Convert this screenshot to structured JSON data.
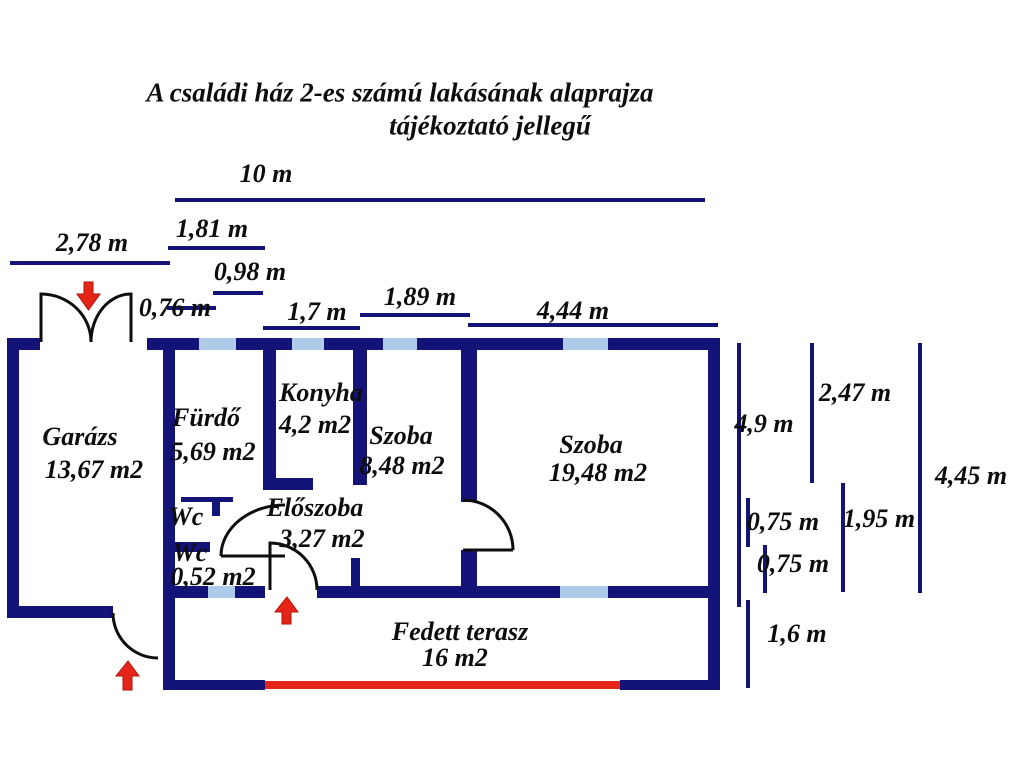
{
  "title": {
    "line1": "A családi ház 2-es számú lakásának alaprajza",
    "line2": "tájékoztató jellegű"
  },
  "rooms": {
    "garage": {
      "name": "Garázs",
      "area": "13,67 m2"
    },
    "bathroom": {
      "name": "Fürdő",
      "area": "5,69 m2"
    },
    "kitchen": {
      "name": "Konyha",
      "area": "4,2 m2"
    },
    "room_small": {
      "name": "Szoba",
      "area": "8,48 m2"
    },
    "room_large": {
      "name": "Szoba",
      "area": "19,48 m2"
    },
    "hallway": {
      "name": "Előszoba",
      "area": "3,27 m2"
    },
    "wc_upper": {
      "name": "Wc"
    },
    "wc_lower": {
      "name": "Wc",
      "area": "0,52 m2"
    },
    "terrace": {
      "name": "Fedett terasz",
      "area": "16 m2"
    }
  },
  "dimensions": {
    "total_width": "10 m",
    "garage_width": "2,78 m",
    "bathroom_width": "1,81 m",
    "window_width": "0,98 m",
    "garage_door_width": "0,76 m",
    "kitchen_width": "1,7 m",
    "room_small_width": "1,89 m",
    "room_large_width": "4,44 m",
    "right_height_full": "4,9 m",
    "room_large_height": "2,47 m",
    "total_height_right": "4,45 m",
    "offset_a": "0,75 m",
    "lower_height": "1,95 m",
    "offset_b": "0,75 m",
    "terrace_height": "1,6 m"
  },
  "colors": {
    "wall": "#141478",
    "window": "#aecbe9",
    "red": "#e42517",
    "text": "#0d0d0d"
  }
}
